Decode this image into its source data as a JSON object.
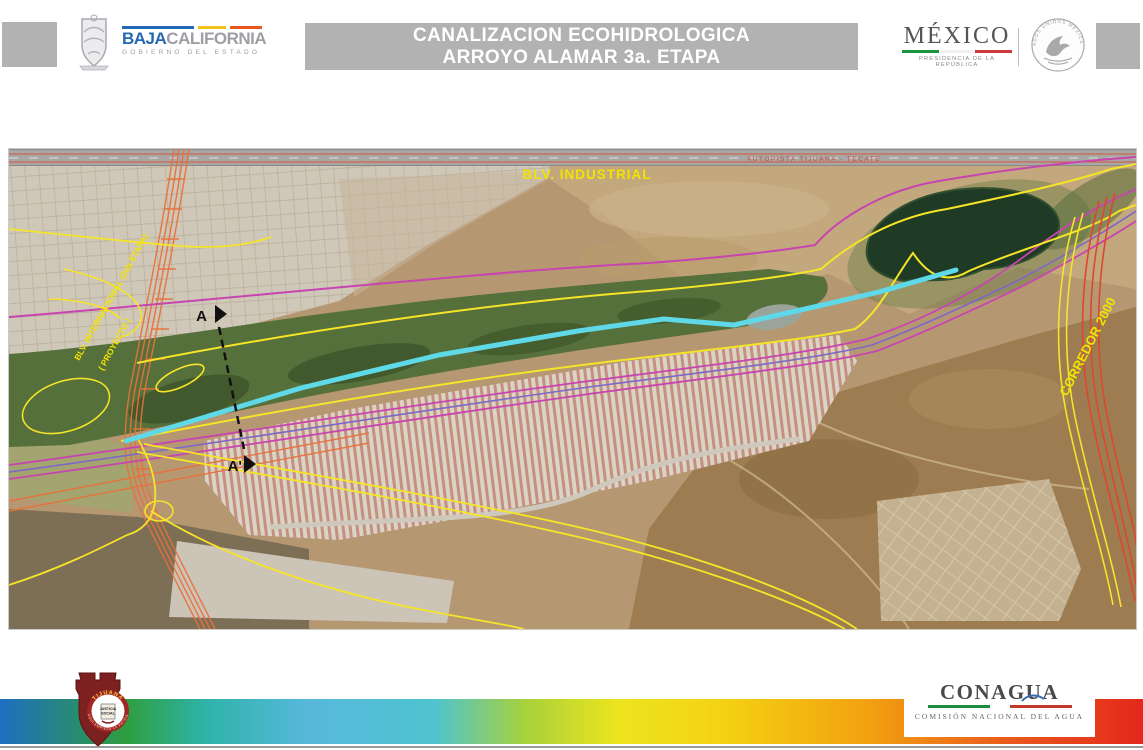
{
  "header": {
    "title_line1": "CANALIZACION ECOHIDROLOGICA",
    "title_line2": "ARROYO ALAMAR 3a. ETAPA",
    "baja_california": {
      "word1": "BAJA",
      "word2": "CALIFORNIA",
      "tagline": "GOBIERNO DEL ESTADO"
    },
    "mexico": {
      "name": "MÉXICO",
      "tagline": "PRESIDENCIA DE LA REPÚBLICA",
      "seal_text": "ESTADOS UNIDOS MEXICANOS"
    }
  },
  "map": {
    "labels": {
      "blv_industrial": "BLV. INDUSTRIAL",
      "autopista": "AUTOPISTA TIJUANA - TECATE",
      "blv_internacional": "BLV. INTERNACIONAL (2da ETAPA)",
      "proyecto": "( PROYECTO )",
      "corredor_2000": "CORREDOR 2000",
      "section_start": "A",
      "section_end": "A'"
    },
    "legend_colors": {
      "canal_route": "#5FD8E8",
      "project_boundary_yellow": "#F5E428",
      "alignment_magenta": "#C844B0",
      "alignment_purple": "#7B68C8",
      "existing_road_red": "#E0462C",
      "proposed_road_orange": "#E8713A"
    }
  },
  "footer": {
    "tijuana": {
      "name": "TIJUANA",
      "motto_line1": "JUSTICIA",
      "motto_line2": "SOCIAL",
      "ring_text": "AQUI EMPIEZA LA PATRIA"
    },
    "conagua": {
      "name": "CONAGUA",
      "tagline": "COMISIÓN NACIONAL DEL AGUA"
    }
  }
}
